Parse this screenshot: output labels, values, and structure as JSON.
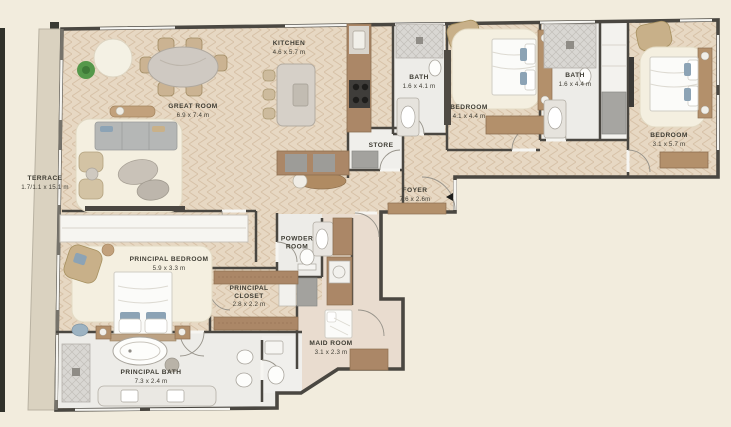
{
  "plan": {
    "type": "apartment-floor-plan",
    "rooms": [
      {
        "id": "terrace",
        "name": "TERRACE",
        "dims": "1.7/1.1 x 15.1 m"
      },
      {
        "id": "great-room",
        "name": "GREAT ROOM",
        "dims": "6.9 x 7.4 m"
      },
      {
        "id": "kitchen",
        "name": "KITCHEN",
        "dims": "4.6 x 5.7 m"
      },
      {
        "id": "bath-1",
        "name": "BATH",
        "dims": "1.6 x 4.1 m"
      },
      {
        "id": "store",
        "name": "STORE",
        "dims": ""
      },
      {
        "id": "bedroom-1",
        "name": "BEDROOM",
        "dims": "4.1 x 4.4 m"
      },
      {
        "id": "bath-2",
        "name": "BATH",
        "dims": "1.6 x 4.4 m"
      },
      {
        "id": "bedroom-2",
        "name": "BEDROOM",
        "dims": "3.1 x 5.7 m"
      },
      {
        "id": "foyer",
        "name": "FOYER",
        "dims": "7.6 x 2.6m"
      },
      {
        "id": "powder-room",
        "name": "POWDER ROOM",
        "dims": ""
      },
      {
        "id": "principal-bedroom",
        "name": "PRINCIPAL BEDROOM",
        "dims": "5.9 x 3.3 m"
      },
      {
        "id": "principal-closet",
        "name": "PRINCIPAL CLOSET",
        "dims": "2.8 x 2.2 m"
      },
      {
        "id": "maid-room",
        "name": "MAID ROOM",
        "dims": "3.1 x 2.3 m"
      },
      {
        "id": "principal-bath",
        "name": "PRINCIPAL BATH",
        "dims": "7.3 x 2.4 m"
      }
    ],
    "entry_marker": "entry-arrow"
  },
  "colors": {
    "background": "#f2ecdd",
    "wood_floor": "#e7d8c3",
    "wood_floor_line": "#d7c2a8",
    "terrace": "#dad2c0",
    "marble": "#edece8",
    "tile": "#e9dccf",
    "wall": "#4a4741",
    "wood_furniture": "#ab8767",
    "light_wood": "#c9b189",
    "gray_furniture": "#b5b7b6",
    "accent_blue": "#8ca3b5",
    "plant_green": "#55984a",
    "rug_cream": "#f4efe0",
    "label_text": "#3e3c33"
  }
}
